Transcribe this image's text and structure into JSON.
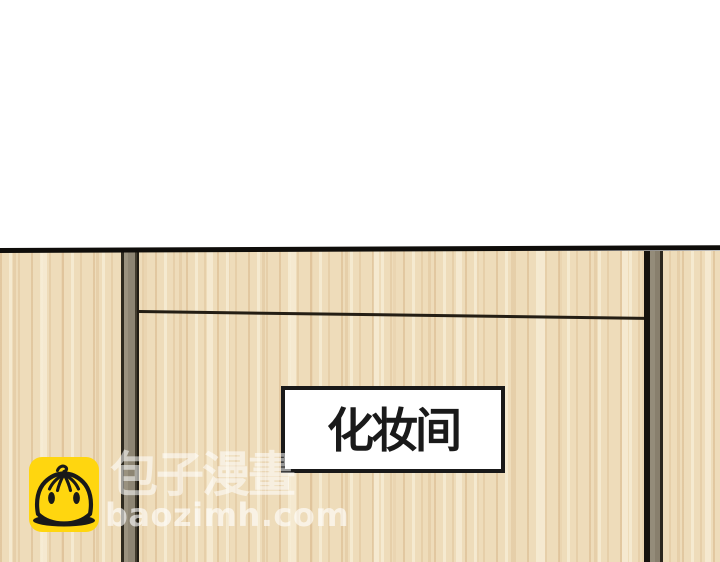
{
  "panel": {
    "description": "comic panel of a wooden wall and door with a room sign",
    "sign": {
      "label": "化妆间"
    },
    "watermark": {
      "site_name": "包子漫畫",
      "site_domain": "baozimh.com",
      "mascot_icon": "baozi-bun-mascot-icon",
      "mascot_color": "#FFD60F"
    },
    "colors": {
      "background": "#FFFFFF",
      "wood_base": "#EEDCBA",
      "frame_gray": "#948C7A",
      "outline_black": "#14110D",
      "sign_background": "#FFFFFF",
      "sign_border": "#191919"
    }
  }
}
